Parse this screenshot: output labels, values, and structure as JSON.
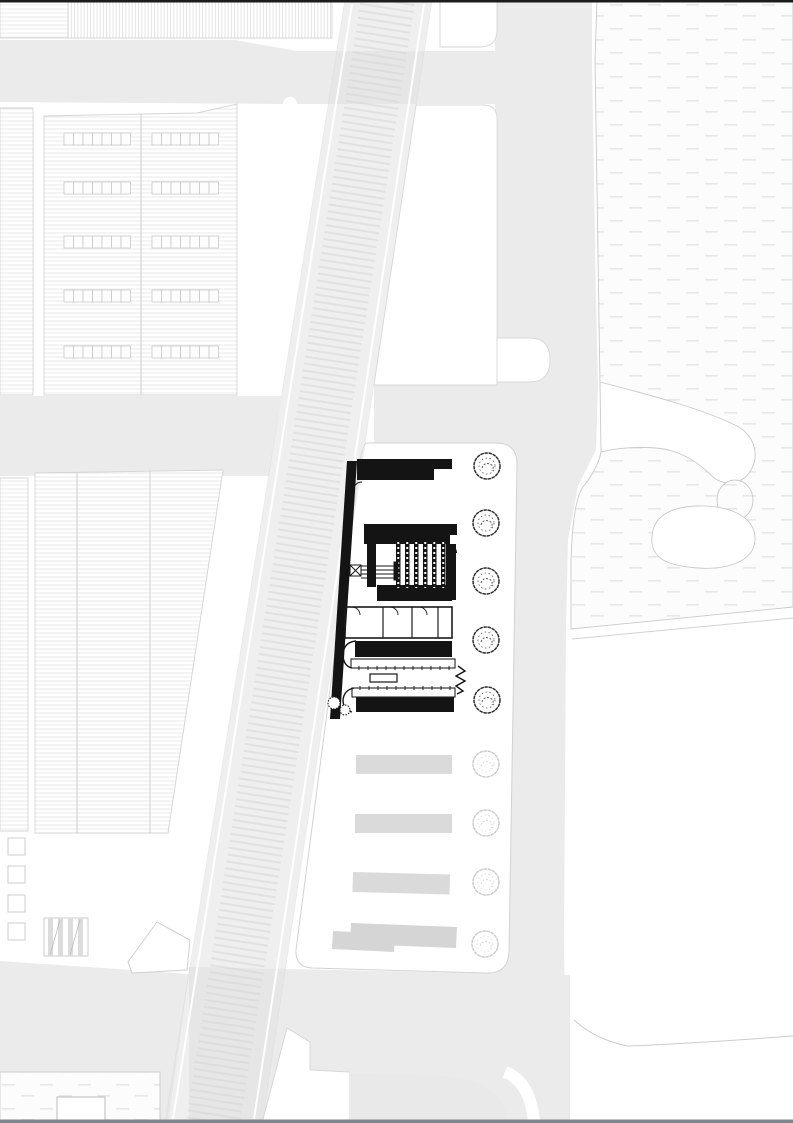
{
  "document": {
    "kind": "architectural-site-plan",
    "orientation": "portrait"
  },
  "palette": {
    "paper": "#ffffff",
    "road": "#ebebeb",
    "rail": "#e2e2e2",
    "rail_tie": "#d4d4d4",
    "grass_dash": "#e7e7e7",
    "grass_edge": "#c9c9c9",
    "roof_line": "#e0e0e0",
    "outline": "#d4d4d4",
    "ink": "#141414",
    "bar_gray": "#dadada",
    "tree_dark": "#2f2f2f",
    "tree_light": "#cccccc",
    "top_border": "#1c1c1c",
    "bottom_border": "#80868d"
  },
  "site": {
    "trees_dark": [
      {
        "cx": 487,
        "cy": 466
      },
      {
        "cx": 486,
        "cy": 523
      },
      {
        "cx": 486,
        "cy": 581
      },
      {
        "cx": 486,
        "cy": 640
      },
      {
        "cx": 487,
        "cy": 700
      }
    ],
    "trees_light": [
      {
        "cx": 486,
        "cy": 764
      },
      {
        "cx": 486,
        "cy": 823
      },
      {
        "cx": 486,
        "cy": 882
      },
      {
        "cx": 485,
        "cy": 944
      }
    ],
    "planting_bars": [
      {
        "x": 356,
        "y": 755,
        "w": 96,
        "h": 19,
        "rot": 0
      },
      {
        "x": 355,
        "y": 814,
        "w": 97,
        "h": 19,
        "rot": 0
      },
      {
        "x": 353,
        "y": 872,
        "w": 97,
        "h": 20,
        "rot": 1.5
      }
    ],
    "planting_bar_polys": [
      "351,923 457,927 456,948 350,944",
      "333,931 395,934 394,952 332,949"
    ],
    "skylight_rows": {
      "ys": [
        133,
        182,
        236,
        290,
        346
      ],
      "groups": [
        {
          "x": 64,
          "cells": 7
        },
        {
          "x": 152,
          "cells": 7
        }
      ],
      "cell_w": 9.5,
      "h": 12
    },
    "yard_squares": {
      "x": 8,
      "w": 17,
      "ys": [
        838,
        866,
        895,
        923
      ]
    },
    "book_stacks": {
      "x0": 396,
      "step": 9,
      "count": 6,
      "y": 540,
      "h": 50,
      "w": 4.5
    }
  }
}
